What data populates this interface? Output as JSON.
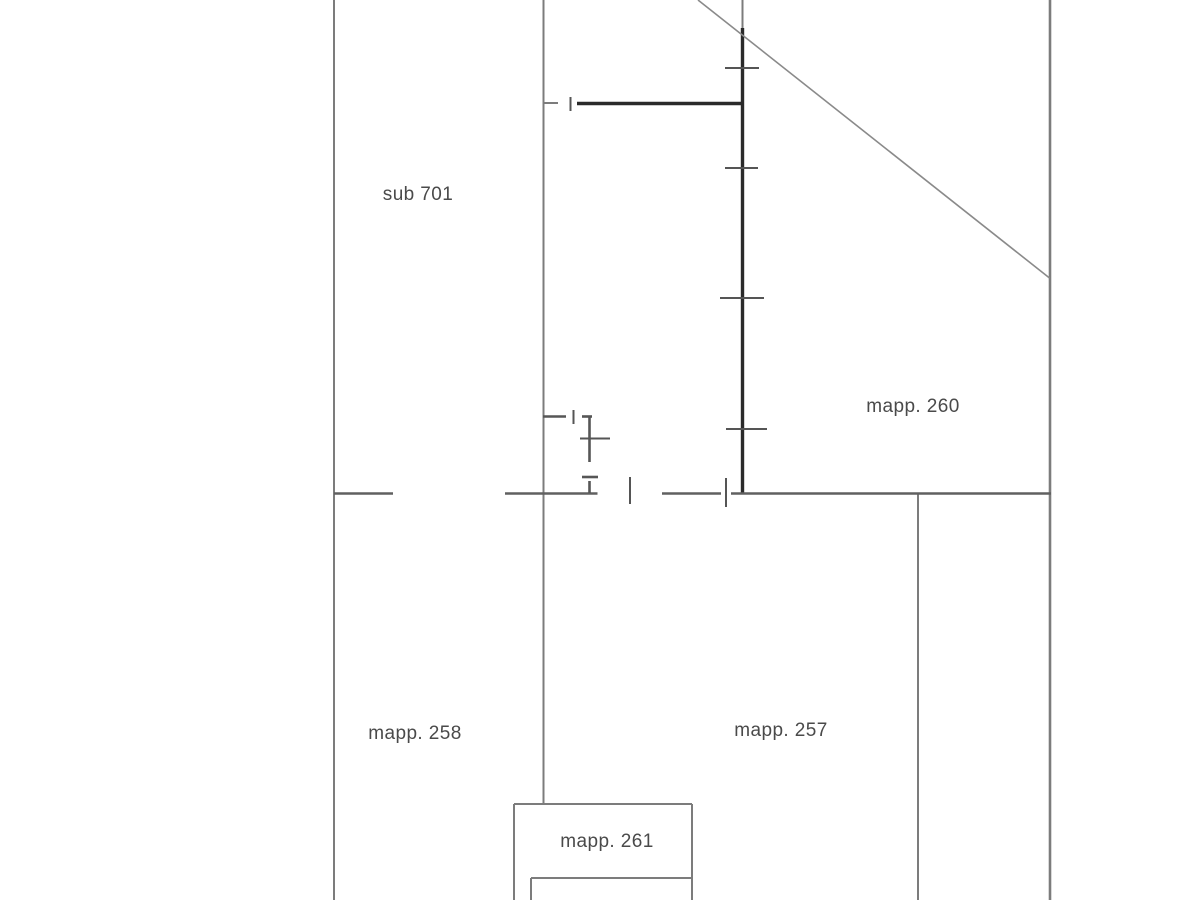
{
  "plan": {
    "type": "cadastral-floor-plan",
    "labels": {
      "sub701": "sub 701",
      "mapp260": "mapp. 260",
      "mapp258": "mapp. 258",
      "mapp257": "mapp. 257",
      "mapp261": "mapp. 261"
    },
    "colors": {
      "thin_line": "#7c7c7c",
      "wall_line": "#606060",
      "bold_line": "#2a2a2a",
      "tick_line": "#555555",
      "door_line": "#565656",
      "diag_line": "#8a8a8a",
      "text": "#4a4a4a",
      "background": "#ffffff"
    }
  }
}
